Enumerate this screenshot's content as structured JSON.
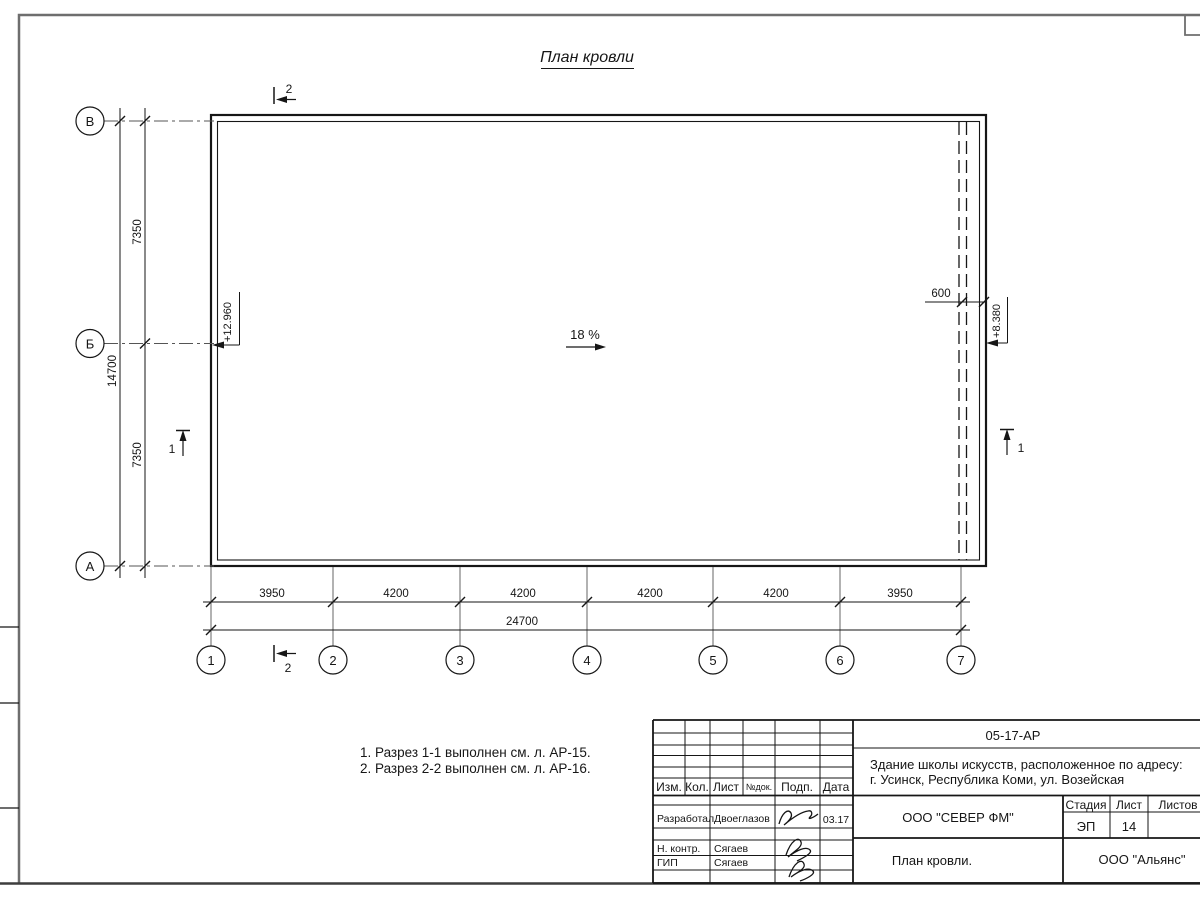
{
  "sheet": {
    "title": "План кровли"
  },
  "colors": {
    "ink": "#161616",
    "frame": "#6e6e6e",
    "grid": "#555555"
  },
  "plan": {
    "slope": "18 %",
    "overhang_dim": "600",
    "elevation_left": "+12.960",
    "elevation_right": "+8.380",
    "row_axes": [
      "В",
      "Б",
      "А"
    ],
    "col_axes": [
      "1",
      "2",
      "3",
      "4",
      "5",
      "6",
      "7"
    ],
    "left_dims": [
      "7350",
      "7350"
    ],
    "left_total_dim": "14700",
    "bottom_dims": [
      "3950",
      "4200",
      "4200",
      "4200",
      "4200",
      "3950"
    ],
    "bottom_total_dim": "24700",
    "section_top": "2",
    "section_bottom": "2",
    "section_left": "1",
    "section_right": "1"
  },
  "notes": [
    "1. Разрез 1-1 выполнен см. л. АР-15.",
    "2. Разрез 2-2 выполнен см. л. АР-16."
  ],
  "title_block": {
    "doc_number": "05-17-АР",
    "object_line1": "Здание школы искусств, расположенное по адресу:",
    "object_line2": "г. Усинск, Республика Коми, ул. Возейская",
    "columns": [
      "Изм.",
      "Кол.",
      "Лист",
      "№док.",
      "Подп.",
      "Дата"
    ],
    "staff": [
      {
        "role": "Разработал",
        "name": "Двоеглазов",
        "date": "03.17"
      },
      {
        "role": "Н. контр.",
        "name": "Сягаев",
        "date": ""
      },
      {
        "role": "ГИП",
        "name": "Сягаев",
        "date": ""
      }
    ],
    "designer_company": "ООО \"СЕВЕР ФМ\"",
    "stage_label": "Стадия",
    "sheet_label": "Лист",
    "sheets_label": "Листов",
    "stage_value": "ЭП",
    "sheet_value": "14",
    "drawing_name": "План кровли.",
    "client_company": "ООО \"Альянс\""
  }
}
